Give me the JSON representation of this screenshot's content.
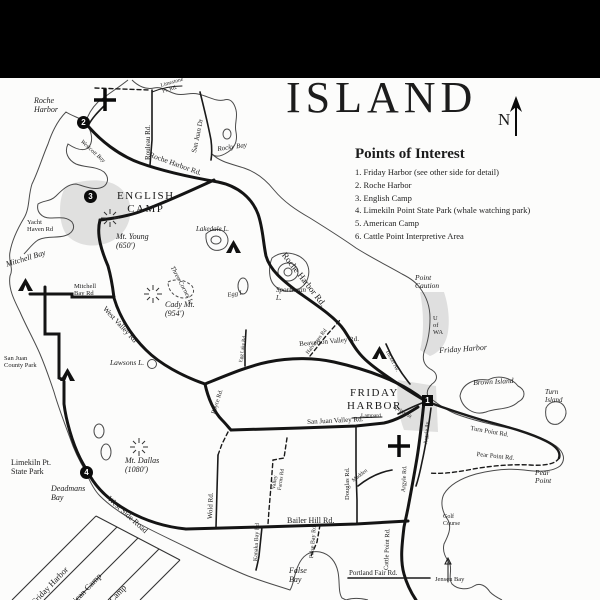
{
  "title": "ISLAND",
  "compass": {
    "label": "N"
  },
  "colors": {
    "ink": "#1b1b1b",
    "shade": "#c9c9c9",
    "paper": "#fcfcfb"
  },
  "poi": {
    "title": "Points of Interest",
    "items": [
      "1. Friday Harbor (see other side for detail)",
      "2. Roche Harbor",
      "3. English Camp",
      "4. Limekiln Point State Park (whale watching park)",
      "5. American Camp",
      "6. Cattle Point Interpretive Area"
    ]
  },
  "markers": [
    {
      "n": "1",
      "x": 422,
      "y": 395,
      "shape": "square"
    },
    {
      "n": "2",
      "x": 77,
      "y": 116,
      "shape": "circle"
    },
    {
      "n": "3",
      "x": 84,
      "y": 190,
      "shape": "circle"
    },
    {
      "n": "4",
      "x": 80,
      "y": 466,
      "shape": "circle"
    }
  ],
  "symbols": {
    "campgrounds": [
      {
        "x": 18,
        "y": 278
      },
      {
        "x": 60,
        "y": 368
      },
      {
        "x": 226,
        "y": 240
      },
      {
        "x": 372,
        "y": 346
      }
    ],
    "summits": [
      {
        "x": 153,
        "y": 294
      },
      {
        "x": 110,
        "y": 218
      },
      {
        "x": 139,
        "y": 447
      }
    ],
    "airports": [
      {
        "x": 105,
        "y": 100
      },
      {
        "x": 399,
        "y": 446
      }
    ]
  },
  "map_labels": [
    {
      "name": "roche-harbor-label",
      "text": "Roche\nHarbor",
      "x": 34,
      "y": 97,
      "size": 8,
      "cls": "it"
    },
    {
      "name": "rouleau-rd-label",
      "text": "Rouleau Rd.",
      "x": 145,
      "y": 160,
      "rot": -90,
      "size": 7
    },
    {
      "name": "limestone-pt-rd-label",
      "text": "Limestone\nPt. Rd.",
      "x": 160,
      "y": 83,
      "rot": -16,
      "size": 5.5
    },
    {
      "name": "san-juan-dr-label",
      "text": "San Juan Dr",
      "x": 191,
      "y": 152,
      "rot": -78,
      "size": 7
    },
    {
      "name": "rocky-bay-label",
      "text": "Rocky Bay",
      "x": 217,
      "y": 146,
      "rot": -8,
      "size": 7,
      "cls": "it"
    },
    {
      "name": "westcott-bay-label",
      "text": "Westcott Bay",
      "x": 83,
      "y": 139,
      "rot": 42,
      "size": 6,
      "cls": "it"
    },
    {
      "name": "roche-harbor-rd-label-west",
      "text": "Roche Harbor Rd.",
      "x": 151,
      "y": 151,
      "rot": 20,
      "size": 7.5
    },
    {
      "name": "english-camp-label",
      "text": "ENGLISH\nCAMP",
      "x": 117,
      "y": 190,
      "size": 11,
      "cls": "town"
    },
    {
      "name": "yacht-haven-rd-label",
      "text": "Yacht\nHaven Rd",
      "x": 27,
      "y": 219,
      "size": 6.5
    },
    {
      "name": "mt-young-label",
      "text": "Mt. Young\n(650')",
      "x": 116,
      "y": 233,
      "size": 8,
      "cls": "it"
    },
    {
      "name": "mitchell-bay-label",
      "text": "Mitchell Bay",
      "x": 5,
      "y": 261,
      "rot": -17,
      "size": 8,
      "cls": "it"
    },
    {
      "name": "mitchell-bay-rd-label",
      "text": "Mitchell\nBay Rd",
      "x": 74,
      "y": 283,
      "size": 6.5
    },
    {
      "name": "cady-mt-label",
      "text": "Cady Mt.\n(954')",
      "x": 165,
      "y": 301,
      "size": 8,
      "cls": "it"
    },
    {
      "name": "west-valley-rd-label",
      "text": "West Valley Rd",
      "x": 107,
      "y": 305,
      "rot": 47,
      "size": 7.5
    },
    {
      "name": "lawsons-lake-label",
      "text": "Lawsons L.",
      "x": 110,
      "y": 359,
      "size": 7.5,
      "cls": "it"
    },
    {
      "name": "san-juan-county-park-label",
      "text": "San Juan\nCounty Park",
      "x": 4,
      "y": 355,
      "size": 6.5
    },
    {
      "name": "lakedale-lake-label",
      "text": "Lakedale L.",
      "x": 196,
      "y": 226,
      "size": 7,
      "cls": "it"
    },
    {
      "name": "egg-lake-label",
      "text": "Egg L.",
      "x": 227,
      "y": 292,
      "rot": -10,
      "size": 6.5,
      "cls": "it"
    },
    {
      "name": "sportsman-lake-label",
      "text": "Sportsman\nL.",
      "x": 276,
      "y": 287,
      "size": 7,
      "cls": "it"
    },
    {
      "name": "three-corner-lake-label",
      "text": "Three Corner L.",
      "x": 175,
      "y": 265,
      "rot": 62,
      "size": 6.5,
      "cls": "it"
    },
    {
      "name": "roche-harbor-rd-label-east",
      "text": "Roche Harbor Rd.",
      "x": 287,
      "y": 251,
      "rot": 52,
      "size": 9
    },
    {
      "name": "point-caution-label",
      "text": "Point\nCaution",
      "x": 415,
      "y": 274,
      "size": 7.5,
      "cls": "it"
    },
    {
      "name": "u-of-wa-label",
      "text": "U\nof\nWA",
      "x": 433,
      "y": 315,
      "size": 6.5
    },
    {
      "name": "friday-harbor-water-label",
      "text": "Friday Harbor",
      "x": 439,
      "y": 347,
      "rot": -4,
      "size": 8,
      "cls": "it"
    },
    {
      "name": "brown-island-label",
      "text": "Brown Island",
      "x": 473,
      "y": 379,
      "rot": -3,
      "size": 7.5,
      "cls": "it"
    },
    {
      "name": "turn-island-label",
      "text": "Turn\nIsland",
      "x": 545,
      "y": 389,
      "size": 7,
      "cls": "it"
    },
    {
      "name": "tucker-ave-label",
      "text": "Tucker Av.",
      "x": 389,
      "y": 349,
      "rot": 62,
      "size": 5.5
    },
    {
      "name": "beaverton-valley-rd-label",
      "text": "Beaverton Valley Rd.",
      "x": 299,
      "y": 341,
      "rot": -5,
      "size": 7
    },
    {
      "name": "friday-harbor-town-label",
      "text": "FRIDAY\nHARBOR",
      "x": 347,
      "y": 387,
      "size": 11,
      "cls": "town"
    },
    {
      "name": "lampard-rd-label",
      "text": "Lampard",
      "x": 361,
      "y": 413,
      "size": 5.5
    },
    {
      "name": "spring-st-label",
      "text": "Spring St",
      "x": 395,
      "y": 404,
      "rot": 32,
      "size": 5.5
    },
    {
      "name": "san-juan-valley-rd-label",
      "text": "San Juan Valley Rd.",
      "x": 307,
      "y": 419,
      "rot": -3,
      "size": 7
    },
    {
      "name": "madden-label",
      "text": "Madden",
      "x": 351,
      "y": 479,
      "rot": -38,
      "size": 5.5
    },
    {
      "name": "douglas-rd-label",
      "text": "Douglas Rd.",
      "x": 344,
      "y": 500,
      "rot": -90,
      "size": 6.5
    },
    {
      "name": "argyle-rd-label",
      "text": "Argyle Rd.",
      "x": 401,
      "y": 492,
      "rot": -87,
      "size": 6
    },
    {
      "name": "argyle-ave-label",
      "text": "Argyle Av.",
      "x": 423,
      "y": 444,
      "rot": -85,
      "size": 5.5
    },
    {
      "name": "turn-point-rd-label",
      "text": "Turn Point Rd.",
      "x": 471,
      "y": 425,
      "rot": 10,
      "size": 6.5
    },
    {
      "name": "pear-point-rd-label",
      "text": "Pear Point Rd.",
      "x": 477,
      "y": 451,
      "rot": 6,
      "size": 6.5
    },
    {
      "name": "pear-point-label",
      "text": "Pear\nPoint",
      "x": 535,
      "y": 469,
      "size": 7.5,
      "cls": "it"
    },
    {
      "name": "cattle-point-rd-label",
      "text": "Cattle Point Rd.",
      "x": 383,
      "y": 570,
      "rot": -88,
      "size": 6.5
    },
    {
      "name": "golf-course-label",
      "text": "Golf\nCourse",
      "x": 443,
      "y": 514,
      "size": 6
    },
    {
      "name": "portland-fair-rd-label",
      "text": "Portland Fair Rd.",
      "x": 349,
      "y": 570,
      "size": 7
    },
    {
      "name": "jensen-bay-label",
      "text": "Jensen Bay",
      "x": 435,
      "y": 576,
      "size": 6.5
    },
    {
      "name": "false-bay-label",
      "text": "False\nBay",
      "x": 289,
      "y": 567,
      "size": 8,
      "cls": "it"
    },
    {
      "name": "false-bay-rd-label",
      "text": "False Bay Rd",
      "x": 309,
      "y": 558,
      "rot": -85,
      "size": 6
    },
    {
      "name": "kanaka-bay-rd-label",
      "text": "Kanaka Bay Rd",
      "x": 253,
      "y": 561,
      "rot": -87,
      "size": 6
    },
    {
      "name": "wold-rd-label",
      "text": "Wold Rd.",
      "x": 207,
      "y": 519,
      "rot": -88,
      "size": 7
    },
    {
      "name": "bailer-hill-rd-label",
      "text": "Bailer Hill Rd.",
      "x": 287,
      "y": 517,
      "size": 8
    },
    {
      "name": "valley-farms-rd-label",
      "text": "Valley\nFarms Rd",
      "x": 271,
      "y": 489,
      "rot": -82,
      "size": 5.5
    },
    {
      "name": "boyce-rd-label",
      "text": "Boyce Rd.",
      "x": 211,
      "y": 413,
      "rot": -72,
      "size": 6
    },
    {
      "name": "egg-lake-rd-label",
      "text": "Egg Lake Rd",
      "x": 239,
      "y": 362,
      "rot": -82,
      "size": 5
    },
    {
      "name": "halvorsen-rd-label",
      "text": "Halvorsen Rd",
      "x": 305,
      "y": 352,
      "rot": -52,
      "size": 5.5
    },
    {
      "name": "limekiln-state-park-label",
      "text": "Limekiln Pt.\nState Park",
      "x": 11,
      "y": 459,
      "size": 8
    },
    {
      "name": "deadmans-bay-label",
      "text": "Deadmans\nBay",
      "x": 51,
      "y": 485,
      "size": 8,
      "cls": "it"
    },
    {
      "name": "mt-dallas-label",
      "text": "Mt. Dallas\n(1080')",
      "x": 125,
      "y": 457,
      "size": 8,
      "cls": "it"
    },
    {
      "name": "west-side-road-label",
      "text": "West Side Road",
      "x": 111,
      "y": 495,
      "rot": 42,
      "size": 8
    },
    {
      "name": "mileage-header-friday-harbor",
      "text": "Friday Harbor",
      "x": 30,
      "y": 600,
      "rot": -46,
      "size": 8.5
    },
    {
      "name": "mileage-header-american-camp",
      "text": "American Camp",
      "x": 58,
      "y": 612,
      "rot": -46,
      "size": 8.5
    },
    {
      "name": "mileage-header-english-camp",
      "text": "English Camp",
      "x": 88,
      "y": 618,
      "rot": -46,
      "size": 8.5
    },
    {
      "name": "mileage-header-park",
      "text": "Park",
      "x": 150,
      "y": 610,
      "rot": -46,
      "size": 8.5
    }
  ]
}
